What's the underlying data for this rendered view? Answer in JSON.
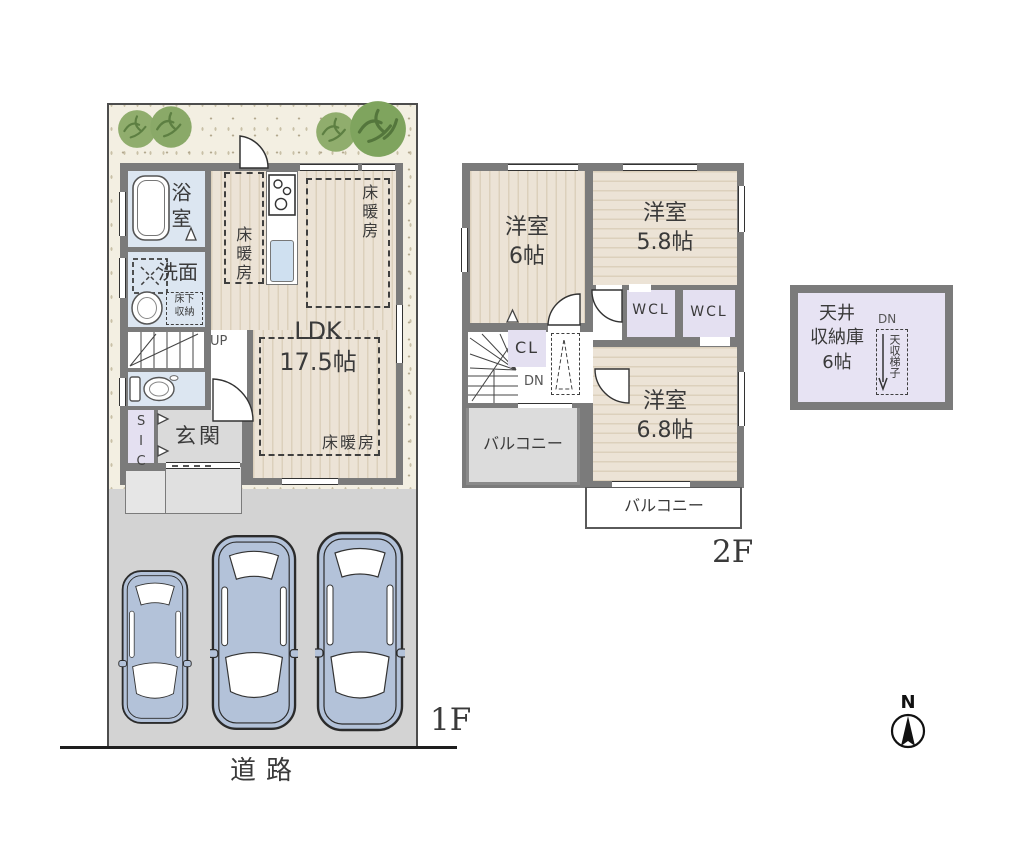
{
  "floor1": {
    "label": "1F",
    "bath": "浴室",
    "washroom": "洗面",
    "underfloor1": "床下",
    "underfloor2": "収納",
    "sic": "SIC",
    "entrance": "玄関",
    "up": "UP",
    "ldk": "LDK",
    "ldk_size": "17.5帖",
    "heating": "床暖房",
    "road": "道路"
  },
  "floor2": {
    "label": "2F",
    "room_name": "洋室",
    "room6_size": "6帖",
    "room58_size": "5.8帖",
    "room68_size": "6.8帖",
    "wcl": "WCL",
    "cl": "CL",
    "dn": "DN",
    "balcony": "バルコニー"
  },
  "attic": {
    "l1": "天井",
    "l2": "収納庫",
    "l3": "6帖",
    "dn": "DN",
    "ladder": "天収梯子"
  },
  "compass": {
    "n": "N"
  },
  "colors": {
    "wall": "#7b7b7b",
    "floor": "#ece3d6",
    "wet_room": "#dce6f1",
    "closet": "#e4e0f1",
    "parking": "#d3d3d3",
    "lot": "#f3efe2",
    "car": "#b3c2d9",
    "tree": "#90ad6d"
  }
}
